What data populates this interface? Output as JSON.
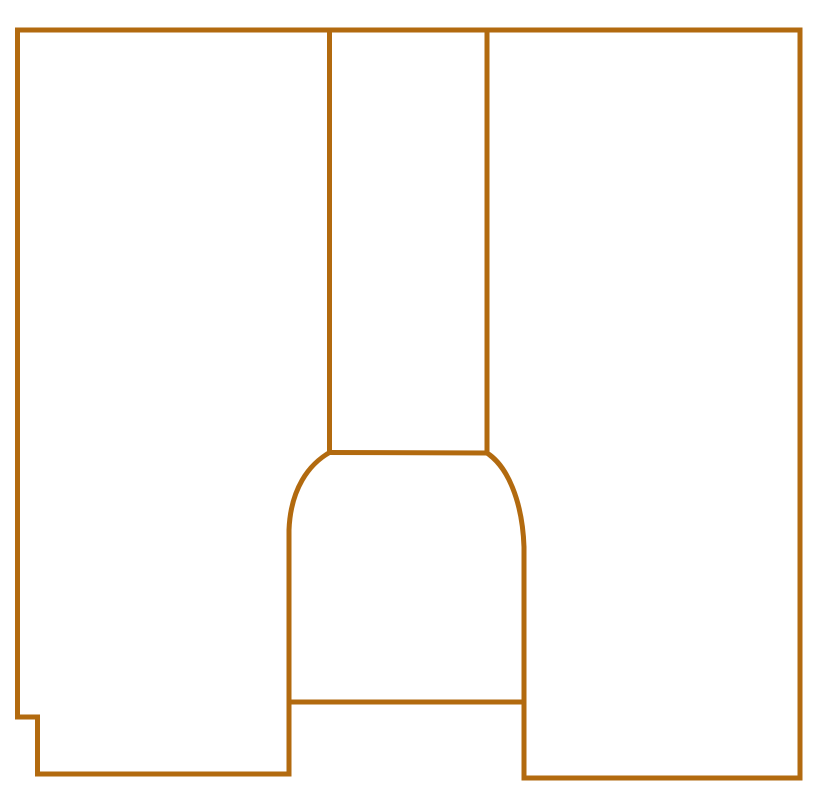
{
  "canvas": {
    "width": 817,
    "height": 810,
    "background_color": "#FFFFFF"
  },
  "style": {
    "stroke_color": "#B26A0F",
    "stroke_width": 5,
    "fill": "none"
  },
  "drawing": {
    "description": "keyhole-shaped outline line drawing",
    "paths": [
      {
        "name": "outer-border",
        "d": "M 289 774 L 37.5 774 L 37.5 717 L 17.5 717 L 17.5 30 L 800 30 L 800 778 L 524 778"
      },
      {
        "name": "channel-left-wall",
        "d": "M 329.5 30 L 329.5 452.5"
      },
      {
        "name": "channel-right-wall",
        "d": "M 487 30 L 487 453"
      },
      {
        "name": "channel-shoulder-line",
        "d": "M 329.5 452.5 L 487 453"
      },
      {
        "name": "bell-left-side",
        "d": "M 329.5 452.5 C 309 464 290.5 489 289 530 L 289 774"
      },
      {
        "name": "bell-right-side",
        "d": "M 487 453 C 507 465.5 522.5 501 524 547 L 524 778"
      },
      {
        "name": "bell-chord-line",
        "d": "M 289 702 L 524 702"
      }
    ]
  }
}
